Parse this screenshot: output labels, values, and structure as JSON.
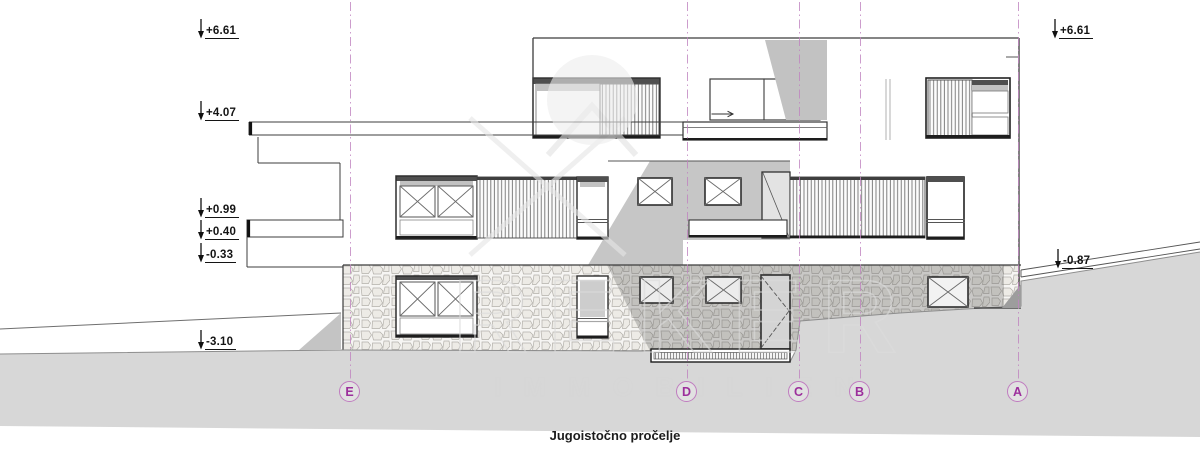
{
  "page": {
    "title": "Jugoistočno pročelje"
  },
  "watermark": {
    "brand": "REKER",
    "tagline": "IMMOBILIEN"
  },
  "levels_left": [
    {
      "label": "+6.61"
    },
    {
      "label": "+4.07"
    },
    {
      "label": "+0.99"
    },
    {
      "label": "+0.40"
    },
    {
      "label": "-0.33"
    },
    {
      "label": "-3.10"
    }
  ],
  "levels_right": [
    {
      "label": "+6.61"
    },
    {
      "label": "-0.87"
    }
  ],
  "grid_axes": [
    {
      "label": "E"
    },
    {
      "label": "D"
    },
    {
      "label": "C"
    },
    {
      "label": "B"
    },
    {
      "label": "A"
    }
  ],
  "colors": {
    "grid_accent": "#b36ab3",
    "line_dark": "#2e2e2e",
    "shadow_gray": "#c6c6c6",
    "terrain_gray": "#d7d7d7",
    "stone_joint": "#b3b0aa"
  }
}
